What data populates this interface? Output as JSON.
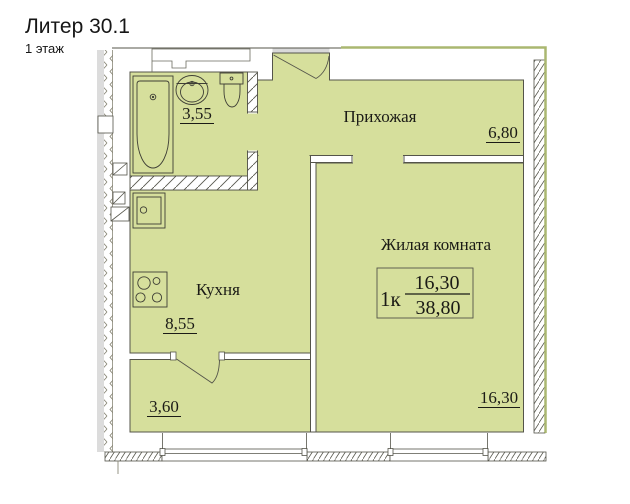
{
  "header": {
    "title": "Литер 30.1",
    "subtitle": "1 этаж"
  },
  "apartment_box": {
    "type_label": "1к",
    "living_area": "16,30",
    "total_area": "38,80"
  },
  "rooms": {
    "hallway": {
      "label": "Прихожая",
      "area": "6,80"
    },
    "living_room": {
      "label": "Жилая комната",
      "area": "16,30"
    },
    "kitchen": {
      "label": "Кухня",
      "area": "8,55"
    },
    "bathroom": {
      "area": "3,55"
    },
    "balcony": {
      "area": "3,60"
    }
  },
  "colors": {
    "room_fill": "#d6df9c",
    "wall_line": "#54544a",
    "outer_edge": "#aab770"
  }
}
